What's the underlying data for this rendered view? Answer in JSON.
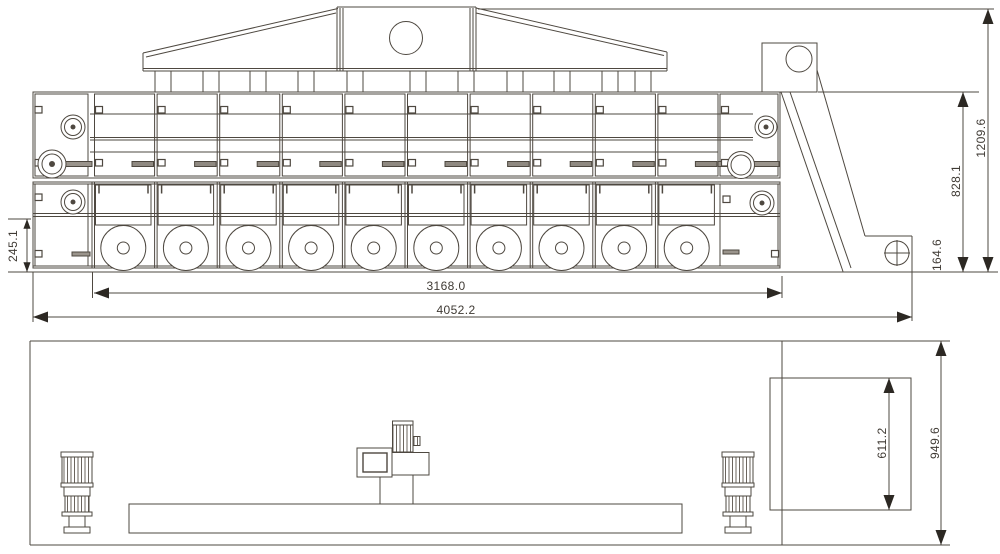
{
  "sheet": {
    "description": "Two-view technical drawing of a mesh-belt dryer with roof exhaust hood and inclined discharge elevator"
  },
  "views": {
    "side": {
      "chambers": 10,
      "fans": 10,
      "roof_ducts": 11
    },
    "plan": {
      "motors": 2
    }
  },
  "dimensions": {
    "overall_height": "1209.6",
    "body_height": "828.1",
    "outlet_height": "164.6",
    "base_section_height": "245.1",
    "chamber_section_length": "3168.0",
    "overall_length": "4052.2",
    "outlet_width": "611.2",
    "overall_width": "949.6"
  },
  "colors": {
    "line": "#4e4840",
    "fill_gray": "#9a948c",
    "handle_gray": "#8f8981",
    "arrow": "#2c2823",
    "background": "#ffffff"
  }
}
